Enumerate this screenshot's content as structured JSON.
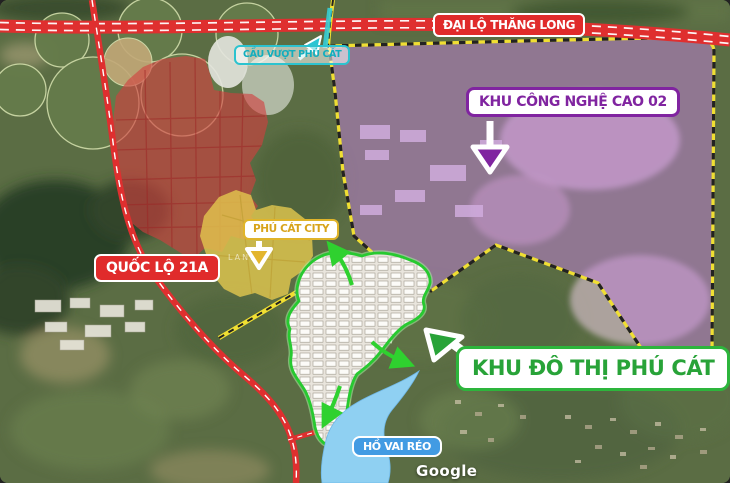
{
  "map": {
    "labels": {
      "boulevard": "ĐẠI LỘ THĂNG LONG",
      "hightech_zone": "KHU CÔNG NGHỆ CAO 02",
      "overpass": "CẦU VƯỢT PHÚ CÁT",
      "highway": "QUỐC LỘ 21A",
      "phu_cat_city": "PHÚ CÁT CITY",
      "urban_area": "KHU ĐÔ THỊ PHÚ CÁT",
      "lake": "HỒ VAI RÉO"
    },
    "watermarks": {
      "provider": "Google",
      "zone_overlay": "LAND"
    },
    "colors": {
      "red_zone": "#d23f3f",
      "yellow_zone": "#e3c84f",
      "hightech_zone": "#bb7fd2",
      "urban_fill": "#edeae3",
      "lake": "#8fd0f2",
      "road_red": "#df2f2f",
      "boundary_yellow": "#f0df32",
      "urban_border_green": "#27c930",
      "label_red": "#e02b2b",
      "label_purple": "#8024a0",
      "label_teal": "#1cb6c6",
      "label_gold": "#d8a41c",
      "label_green": "#28a338",
      "label_lake_blue": "#429be3",
      "overpass_teal": "#35cdd6"
    }
  }
}
